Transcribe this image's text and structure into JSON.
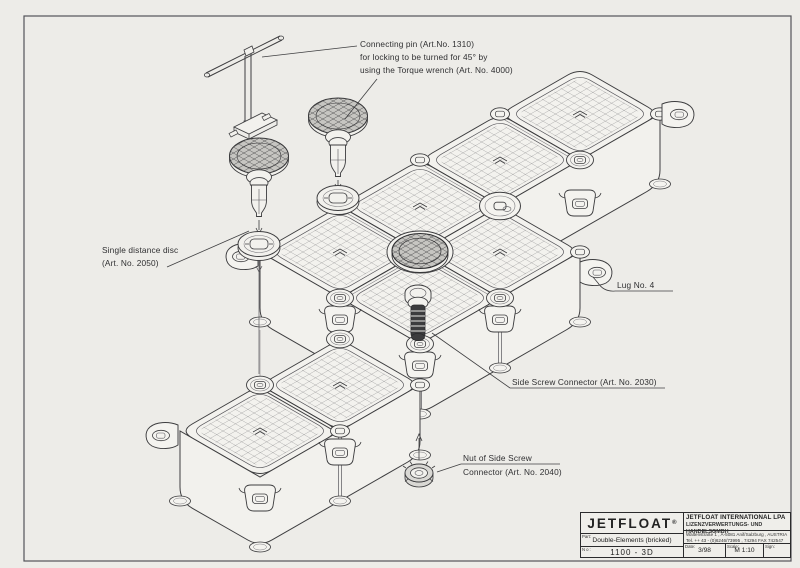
{
  "sheet": {
    "number": "017"
  },
  "annotations": {
    "connecting_pin_l1": "Connecting pin (Art.No. 1310)",
    "connecting_pin_l2": "for locking to be turned for 45° by",
    "connecting_pin_l3": "using the Torque wrench (Art. No. 4000)",
    "distance_disc_l1": "Single distance disc",
    "distance_disc_l2": "(Art. No. 2050)",
    "lug": "Lug No. 4",
    "side_screw": "Side Screw Connector (Art. No. 2030)",
    "nut_l1": "Nut of Side Screw",
    "nut_l2": "Connector (Art. No. 2040)"
  },
  "title_block": {
    "brand": "JETFLOAT",
    "brand_reg": "®",
    "company_line1": "JETFLOAT INTERNATIONAL LPA",
    "company_line2": "LIZENZVERWERTUNGS- UND HANDELSGMBH",
    "address_line1": "Waltenstraße 1 , A-5081 Anif/Salzburg , AUSTRIA",
    "address_line2": "Tel. ++ 43 - (0)6246/73995 , 74294 FAX 742547",
    "part_label": "Part:",
    "part_value": "Double-Elements (bricked)",
    "no_label": "No:",
    "no_value": "1100 - 3D",
    "date_label": "Date:",
    "date_value": "3/98",
    "scale_label": "Scale:",
    "scale_value": "M 1:10",
    "sign_label": "Sign:",
    "sign_value": ""
  },
  "colors": {
    "paper": "#edece8",
    "ink": "#3d3d3f",
    "dark": "#2b2b2d"
  }
}
